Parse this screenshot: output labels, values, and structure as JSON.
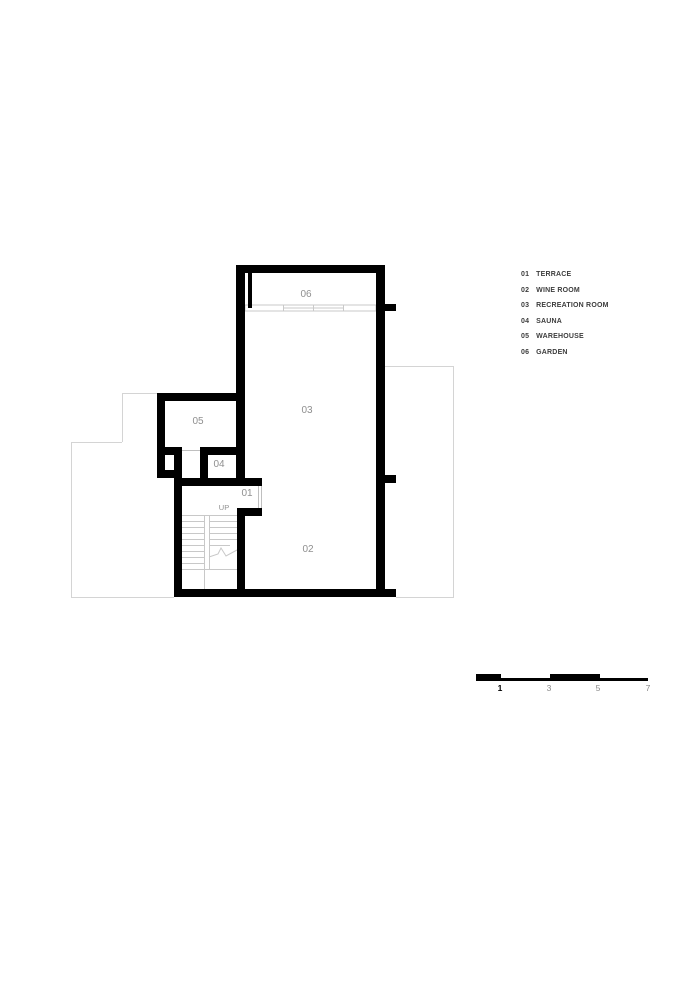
{
  "title": "Basement floor plan",
  "colors": {
    "wall": "#000000",
    "room_label": "#8f8f8f",
    "legend_text": "#3d3d3d",
    "upper_floor_outline": "#d4d4d4",
    "stair_lines": "#c8c8c8",
    "background": "#ffffff"
  },
  "plan": {
    "rooms": [
      {
        "number": "06"
      },
      {
        "number": "03"
      },
      {
        "number": "05"
      },
      {
        "number": "04"
      },
      {
        "number": "01"
      },
      {
        "number": "02"
      }
    ],
    "stair_label": "UP"
  },
  "legend": {
    "items": [
      {
        "code": "01",
        "name": "TERRACE"
      },
      {
        "code": "02",
        "name": "WINE ROOM"
      },
      {
        "code": "03",
        "name": "RECREATION ROOM"
      },
      {
        "code": "04",
        "name": "SAUNA"
      },
      {
        "code": "05",
        "name": "WAREHOUSE"
      },
      {
        "code": "06",
        "name": "GARDEN"
      }
    ]
  },
  "scale_bar": {
    "labels": [
      "1",
      "3",
      "5",
      "7"
    ]
  }
}
